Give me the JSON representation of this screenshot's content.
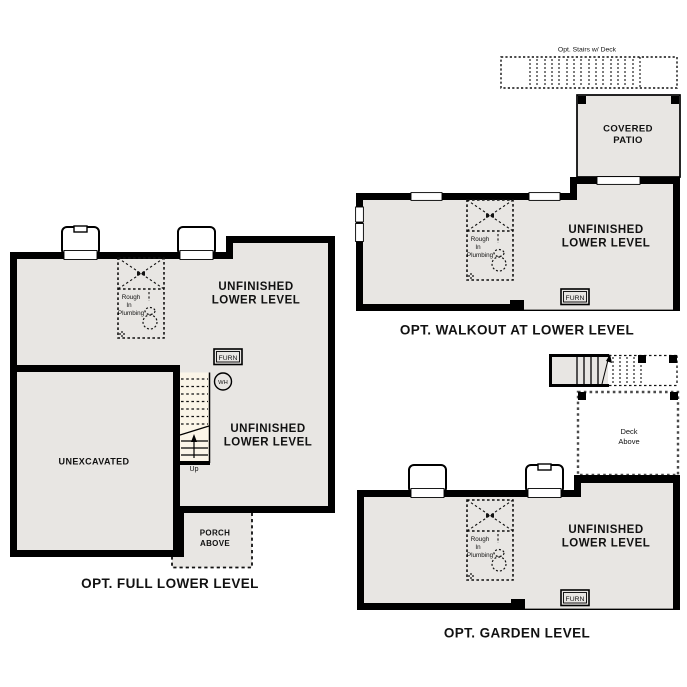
{
  "document": {
    "type": "basement floor plan options sheet",
    "background": "#ffffff"
  },
  "colors": {
    "floor_fill": "#e8e6e3",
    "wall": "#000000",
    "stair_fill": "#fbf5e8",
    "deck_dash": "#4a4a4a",
    "text": "#111111"
  },
  "labels": {
    "unfinished_line1": "UNFINISHED",
    "unfinished_line2": "LOWER LEVEL",
    "furn": "FURN",
    "rough_line1": "Rough",
    "rough_line2": "In",
    "rough_line3": "Plumbing"
  },
  "plans": {
    "full": {
      "title": "OPT. FULL LOWER LEVEL",
      "unexcavated": "UNEXCAVATED",
      "porch_line1": "PORCH",
      "porch_line2": "ABOVE",
      "water_heater": "WH",
      "stairs_up": "Up"
    },
    "walkout": {
      "title": "OPT. WALKOUT AT LOWER LEVEL",
      "opt_stairs": "Opt. Stairs w/ Deck",
      "patio_line1": "COVERED",
      "patio_line2": "PATIO"
    },
    "garden": {
      "title": "OPT. GARDEN LEVEL",
      "deck_line1": "Deck",
      "deck_line2": "Above"
    }
  }
}
